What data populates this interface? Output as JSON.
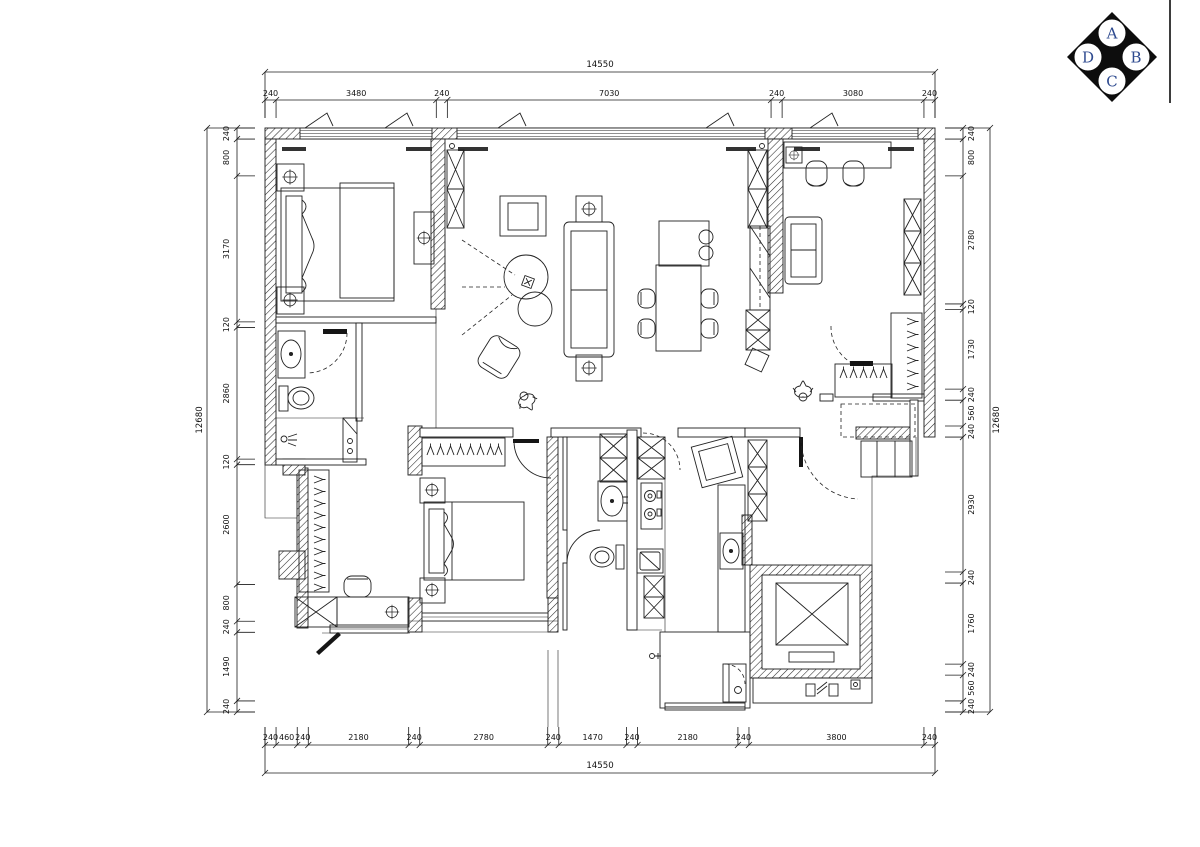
{
  "compass": {
    "top": "A",
    "right": "B",
    "bottom": "C",
    "left": "D"
  },
  "dimensions": {
    "top": {
      "total": "14550",
      "segments": [
        "240",
        "3480",
        "240",
        "7030",
        "240",
        "3080",
        "240"
      ]
    },
    "bottom": {
      "total": "14550",
      "segments": [
        "240",
        "460",
        "240",
        "2180",
        "240",
        "2780",
        "240",
        "1470",
        "240",
        "2180",
        "240",
        "3800",
        "240"
      ]
    },
    "left": {
      "total": "12680",
      "segments": [
        "240",
        "800",
        "3170",
        "120",
        "2860",
        "120",
        "2600",
        "800",
        "240",
        "1490",
        "240"
      ]
    },
    "right": {
      "total": "12680",
      "segments": [
        "240",
        "800",
        "2780",
        "120",
        "1730",
        "240",
        "560",
        "240",
        "2930",
        "240",
        "1760",
        "240",
        "560",
        "240"
      ]
    }
  },
  "colors": {
    "line": "#1b1b1b",
    "background": "#ffffff",
    "dim_text": "#111111",
    "compass_fill": "#0d0d0d",
    "compass_letter": "#2e4a8f"
  }
}
